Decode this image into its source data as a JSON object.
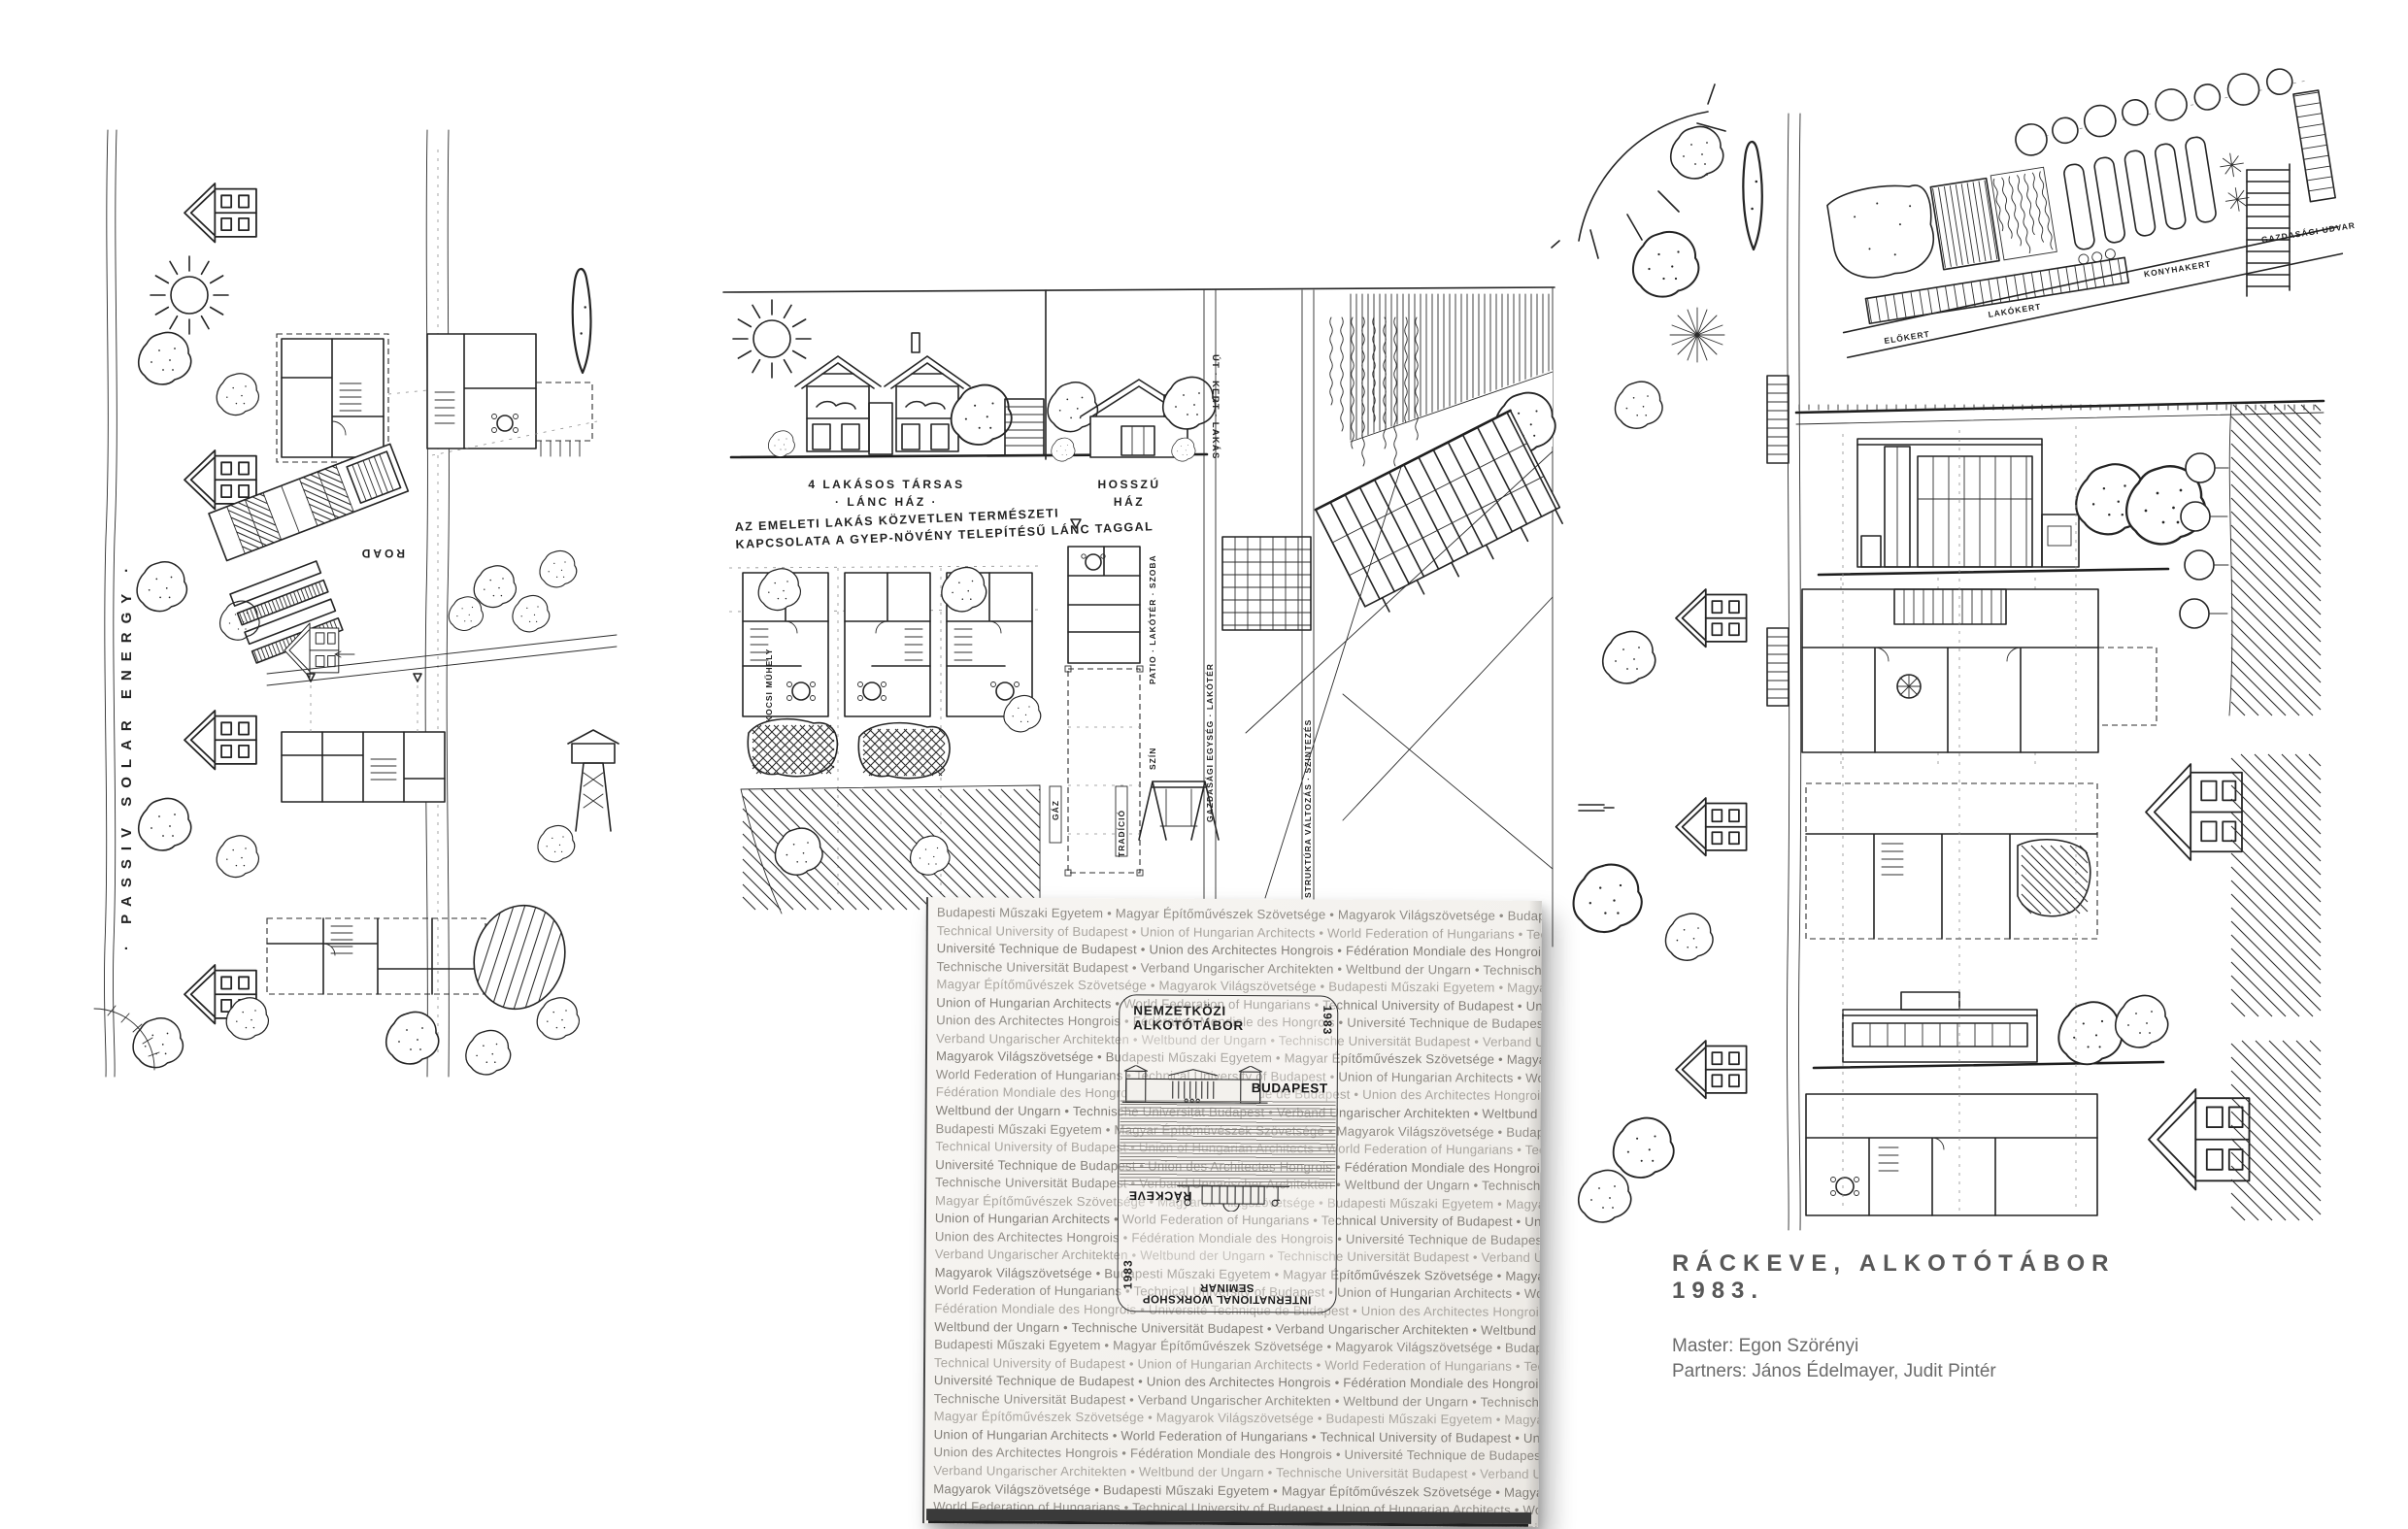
{
  "page": {
    "background": "#ffffff"
  },
  "caption": {
    "title": "RÁCKEVE, ALKOTÓTÁBOR 1983.",
    "master": "Master: Egon Szörényi",
    "partners": "Partners: János Édelmayer, Judit Pintér"
  },
  "booklet": {
    "pattern_repeats": 3,
    "pattern_lines": [
      "Budapesti Műszaki Egyetem • Magyar Építőművészek Szövetsége • Magyarok Világszövetsége • Budapesti Műszaki Egyetem • Magyar",
      "Technical University of Budapest • Union of Hungarian Architects • World Federation of Hungarians • Technical University of Budapest",
      "Université Technique de Budapest • Union des Architectes Hongrois • Fédération Mondiale des Hongrois • Université Technique de",
      "Technische Universität Budapest • Verband Ungarischer Architekten • Weltbund der Ungarn • Technische Universität Budapest • Verband",
      "Magyar Építőművészek Szövetsége • Magyarok Világszövetsége • Budapesti Műszaki Egyetem • Magyar Építőművészek Szövetsége",
      "Union of Hungarian Architects • World Federation of Hungarians • Technical University of Budapest • Union of Hungarian Architects",
      "Union des Architectes Hongrois • Fédération Mondiale des Hongrois • Université Technique de Budapest • Union des Architectes Hongrois",
      "Verband Ungarischer Architekten • Weltbund der Ungarn • Technische Universität Budapest • Verband Ungarischer Architekten • Weltbund",
      "Magyarok Világszövetsége • Budapesti Műszaki Egyetem • Magyar Építőművészek Szövetsége • Magyarok Világszövetsége • Budapesti",
      "World Federation of Hungarians • Technical University of Budapest • Union of Hungarian Architects • World Federation of Hungarians",
      "Fédération Mondiale des Hongrois • Université Technique de Budapest • Union des Architectes Hongrois • Fédération Mondiale des Hongrois",
      "Weltbund der Ungarn • Technische Universität Budapest • Verband Ungarischer Architekten • Weltbund der Ungarn • Technische Universität"
    ],
    "emblem": {
      "title": "NEMZETKÖZI ALKOTÓTÁBOR",
      "year_right": "1983",
      "city_top": "BUDAPEST",
      "city_bottom": "RÁCKEVE",
      "year_left": "1983",
      "subtitle": "INTERNATIONAL WORKSHOP SEMINAR"
    }
  },
  "drawings": {
    "left": {
      "side_label": "· PASSIV SOLAR ENERGY ·",
      "road_label": "ROAD"
    },
    "middle": {
      "chain_house_line1": "4 LAKÁSOS TÁRSAS",
      "chain_house_line2": "· LÁNC HÁZ ·",
      "long_house_line1": "HOSSZÚ",
      "long_house_line2": "HÁZ",
      "annotation_line1": "AZ EMELETI LAKÁS KÖZVETLEN TERMÉSZETI",
      "annotation_line2": "KAPCSOLATA A GYEP-NÖVÉNY TELEPÍTÉSŰ LÁNC TAGGAL",
      "strip_road": "ÚT · KERT · LAKÁS",
      "strip_patio": "PATIO · LAKÓTÉR · SZOBA",
      "strip_economy": "GAZDASÁGI EGYSÉG · LAKÓTÉR",
      "strip_garage": "GÉPKOCSI MŰHELY",
      "strip_gas": "GÁZ",
      "strip_tradition": "TRADÍCIÓ",
      "strip_structure": "STRUKTÚRA VÁLTOZÁS · SZINTEZÉS",
      "strip_shed": "SZÍN"
    },
    "right": {
      "garden_labels": [
        "ELŐKERT",
        "LAKÓKERT",
        "KONYHAKERT",
        "GAZDASÁGI UDVAR"
      ]
    }
  }
}
